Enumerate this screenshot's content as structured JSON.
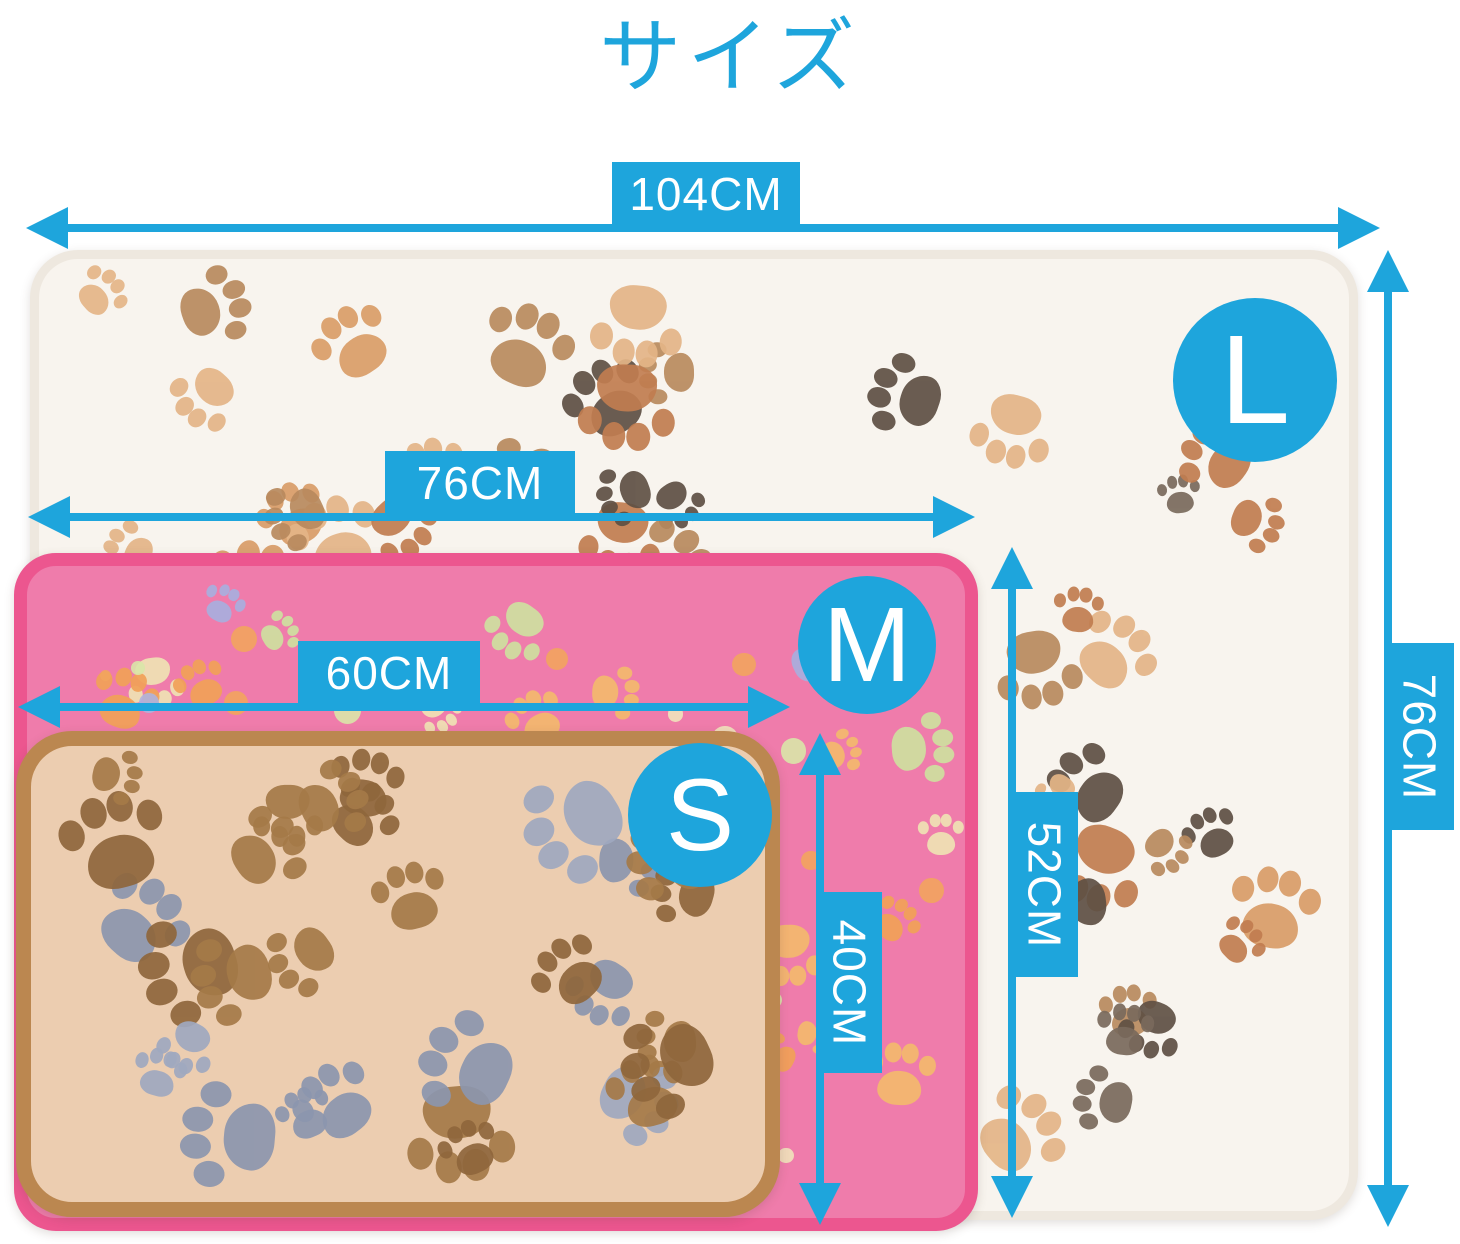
{
  "title": "サイズ",
  "accent_color": "#1ea5dc",
  "items": {
    "l": {
      "label": "L",
      "width": "104CM",
      "height": "76CM",
      "base_color": "#f8f4ee",
      "border_color": "#eee8df",
      "paw_colors": [
        "#5f5044",
        "#7a6a5c",
        "#c17d50",
        "#d99d68",
        "#e4b587",
        "#b98a5e"
      ]
    },
    "m": {
      "label": "M",
      "width": "76CM",
      "height": "52CM",
      "base_color": "#ef7cab",
      "border_color": "#ec568f",
      "paw_colors": [
        "#cfe0a0",
        "#f2a158",
        "#a9aede",
        "#f0e3b4",
        "#f4b96e"
      ],
      "dot_colors": [
        "#d9e6a8",
        "#f2a45e",
        "#aeb3de",
        "#efe3bb"
      ]
    },
    "s": {
      "label": "S",
      "width": "60CM",
      "height": "40CM",
      "base_color": "#eccdb0",
      "border_color": "#bb8750",
      "paw_colors": [
        "#8c96ae",
        "#a0a9c0",
        "#a57a48",
        "#8f673c"
      ]
    }
  }
}
